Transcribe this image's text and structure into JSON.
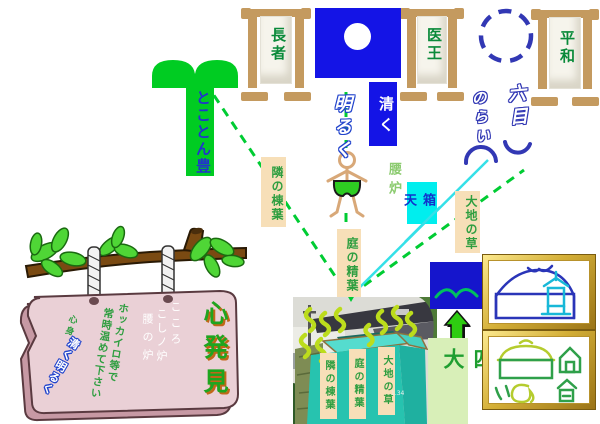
{
  "banners": {
    "choja": "長者",
    "io": "医王",
    "heiwa": "平和"
  },
  "flag": {
    "slogan_solid": "清く",
    "slogan_outline": "明るく"
  },
  "heart_motto": "とことん豊",
  "right_motto": {
    "right_col": "六目",
    "left_col": "のらい"
  },
  "person": {
    "label": "腰炉"
  },
  "source_labels": {
    "neighbor": "隣の棟葉",
    "garden": "庭の精葉",
    "box_heaven": "箱天",
    "earth": "大地の草"
  },
  "four_elements": "四大",
  "photo": {
    "bin_labels": [
      "隣の棟葉",
      "庭の精葉",
      "大地の草"
    ],
    "stamp": "1.34"
  },
  "sign": {
    "title": "心発見",
    "inscriptions": [
      "こころ",
      "こしノ炉",
      "腰の炉"
    ],
    "notice": [
      "ホッカイロ等で",
      "常時温めて下さい"
    ],
    "mind_body": "心身",
    "slogan": "清く明るく"
  },
  "colors": {
    "accent_green": "#00CC22",
    "dash_green": "#00CC33",
    "flag_blue": "#1414E6",
    "navy": "#3238B4",
    "cyan_line": "#35E0E8",
    "wheat": "#F7DFB8",
    "label_green": "#2E9E40",
    "board_pink": "#EAD0D6",
    "gold": "#D4AF37",
    "teal_bin": "#27C3AF"
  }
}
